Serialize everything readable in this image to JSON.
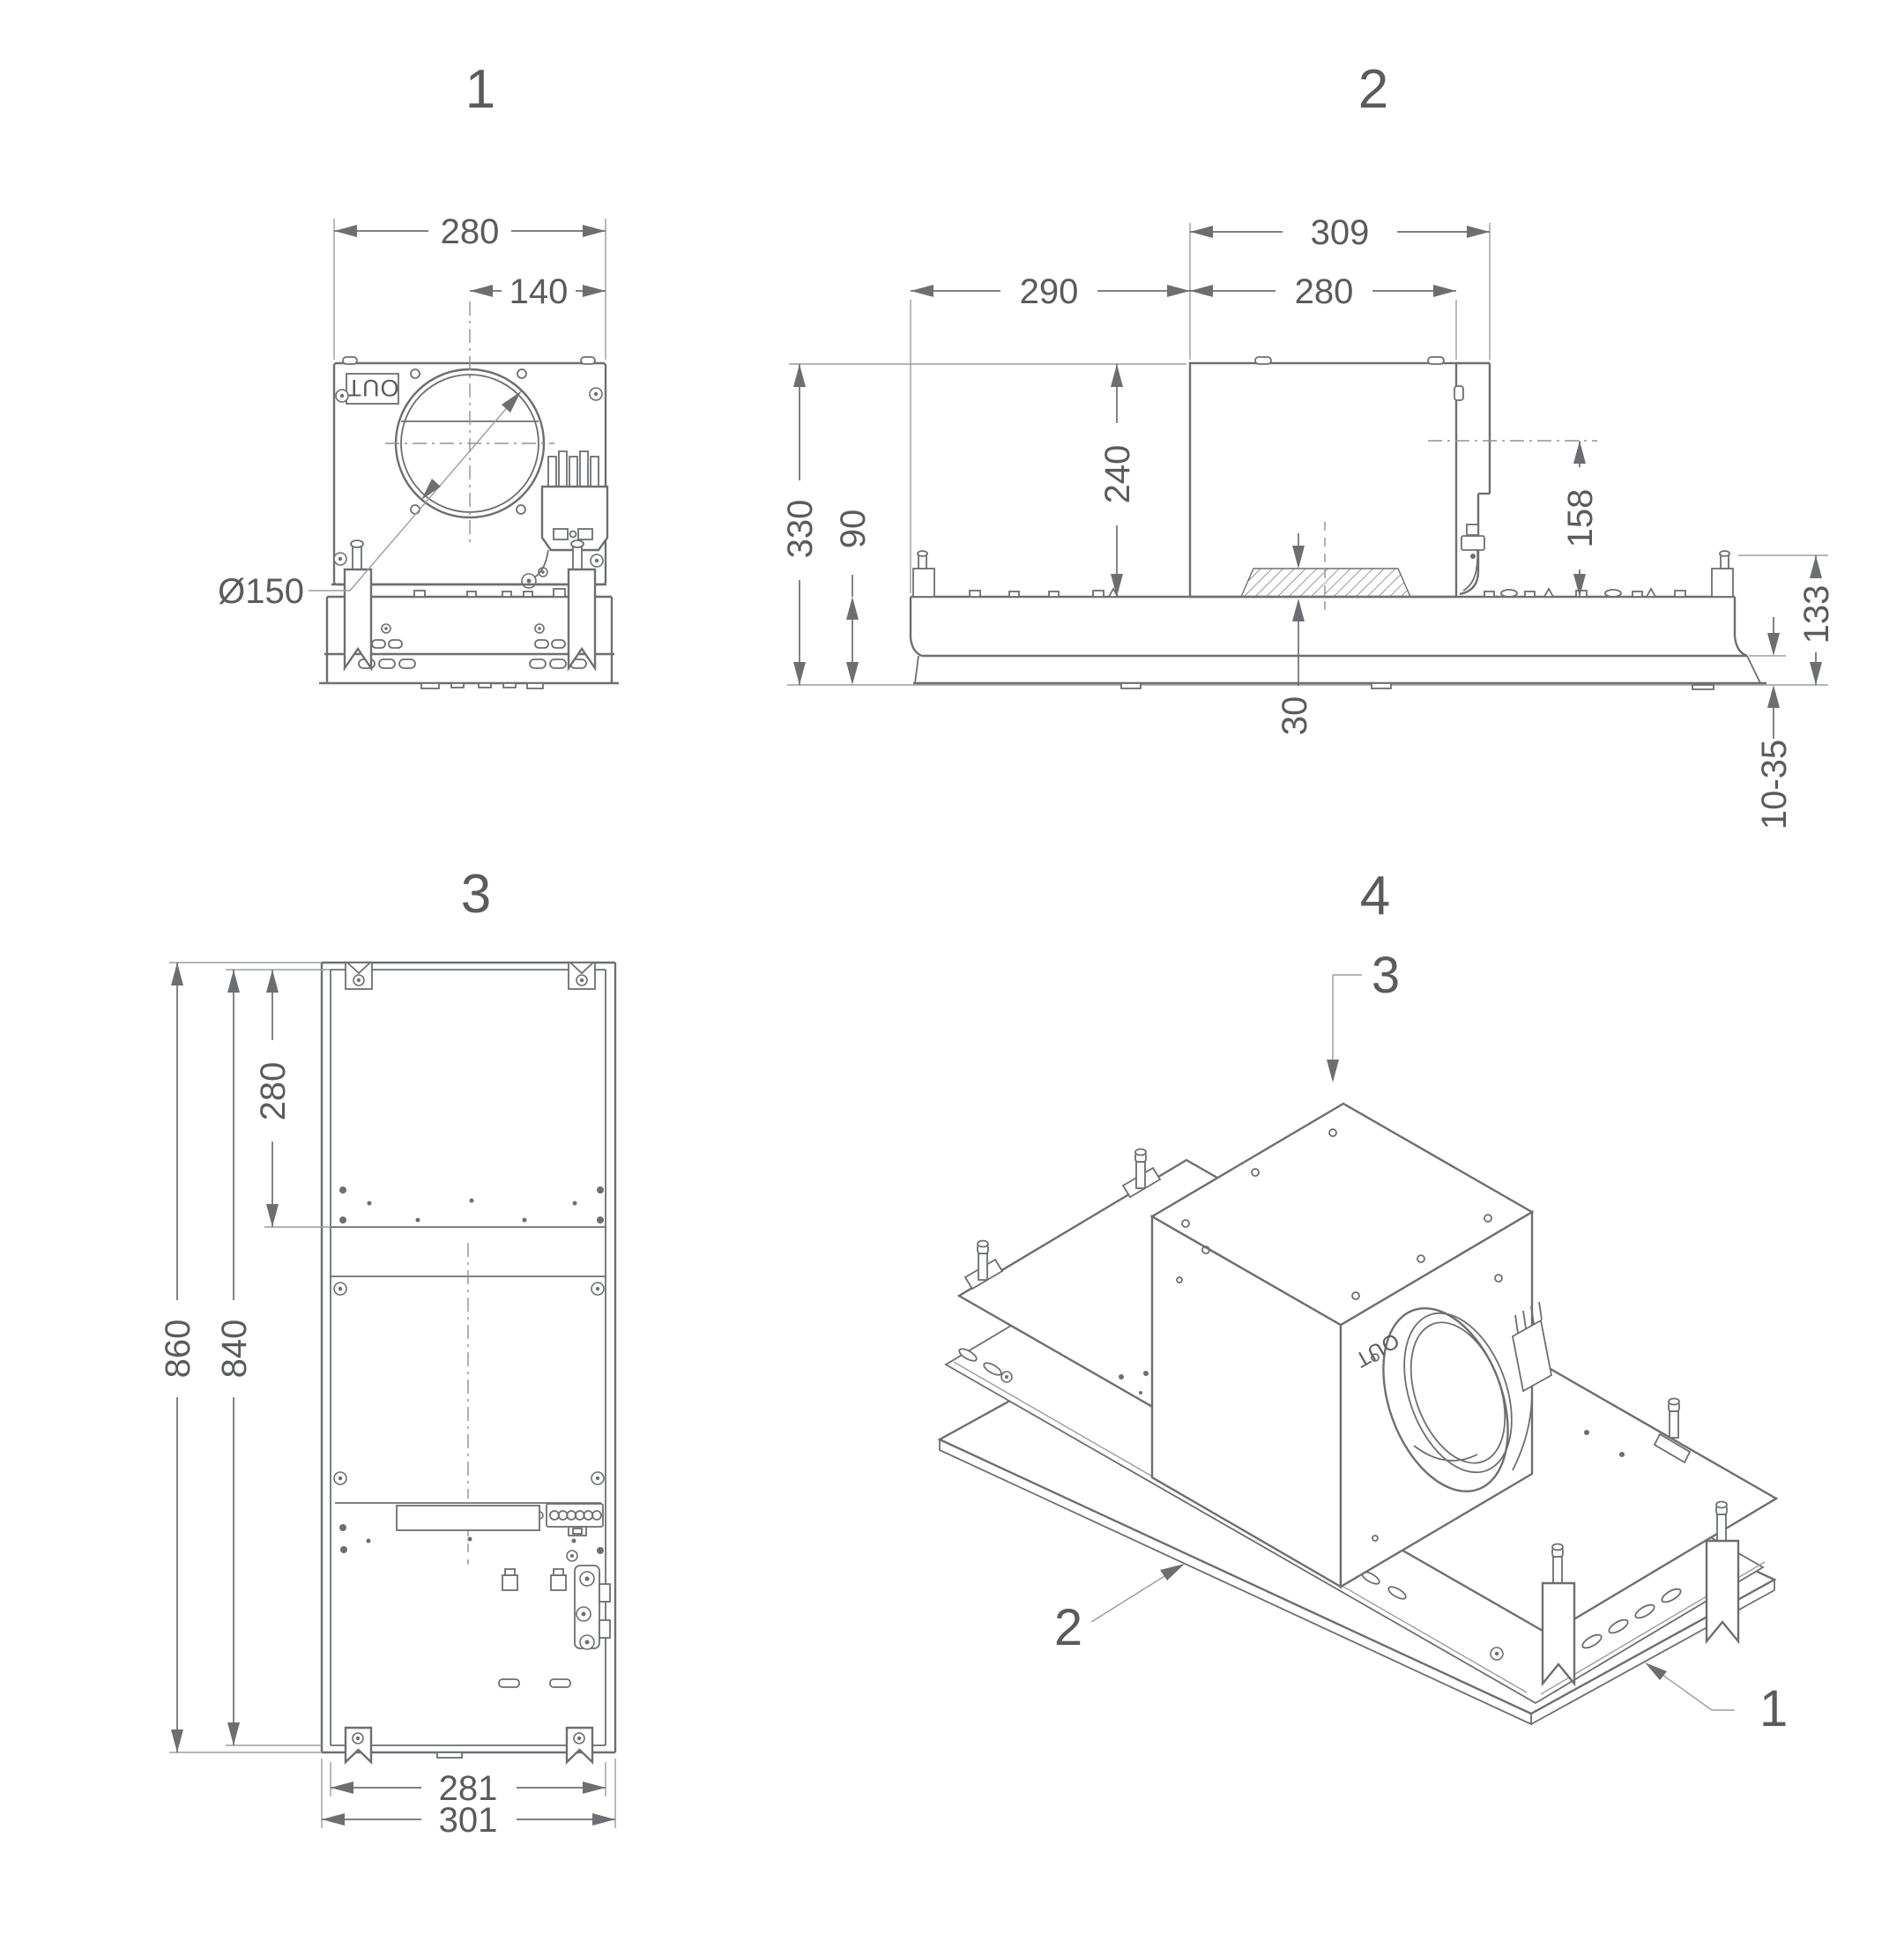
{
  "drawing": {
    "background": "#ffffff",
    "line_color": "#6c6f72",
    "text_color": "#595b5d",
    "views": {
      "front": {
        "title": "1",
        "out_label": "OUT",
        "dims": {
          "width": "280",
          "center_to_edge": "140",
          "duct_diameter": "Ø150"
        }
      },
      "side": {
        "title": "2",
        "dims": {
          "body_with_duct": "309",
          "duct_offset": "290",
          "body_width": "280",
          "total_height": "330",
          "plenum_height": "90",
          "body_height": "240",
          "duct_axis_height": "158",
          "frame_height": "133",
          "pad_thickness": "30",
          "ceiling_thickness": "10-35"
        }
      },
      "bottom": {
        "title": "3",
        "dims": {
          "top_section": "280",
          "overall_length": "860",
          "inner_length": "840",
          "inner_width": "281",
          "outer_width": "301"
        }
      },
      "iso": {
        "title": "4",
        "out_label": "OUT",
        "callouts": {
          "motor_unit": "3",
          "tray": "2",
          "frame": "1"
        }
      }
    }
  }
}
